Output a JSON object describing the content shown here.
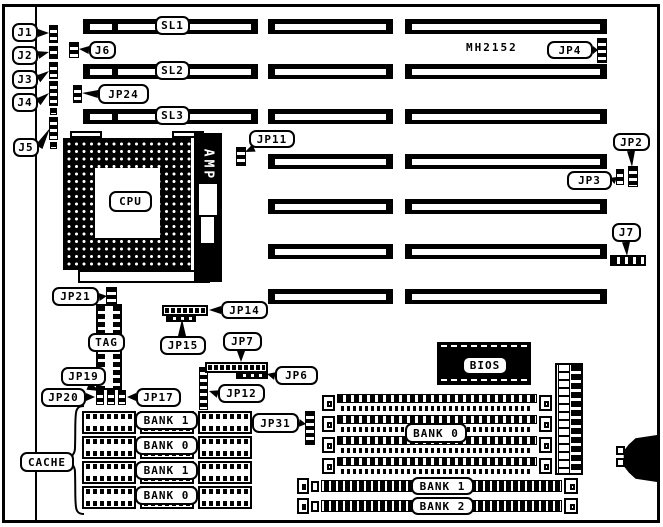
{
  "board": {
    "model": "MH2152"
  },
  "chips": {
    "cpu": "CPU",
    "amp": "AMP",
    "tag": "TAG",
    "bios": "BIOS"
  },
  "memory": {
    "cache_label": "CACHE",
    "cache_banks": [
      "BANK 1",
      "BANK 0",
      "BANK 1",
      "BANK 0"
    ],
    "simm30_label": "BANK 0",
    "simm72_labels": [
      "BANK 1",
      "BANK 2"
    ]
  },
  "slots": {
    "labels": [
      "SL1",
      "SL2",
      "SL3"
    ]
  },
  "plates": [
    {
      "label": "SL1",
      "name": "slot-label-sl1",
      "box": [
        155,
        16,
        35,
        19
      ]
    },
    {
      "label": "SL2",
      "name": "slot-label-sl2",
      "box": [
        155,
        61,
        35,
        19
      ]
    },
    {
      "label": "SL3",
      "name": "slot-label-sl3",
      "box": [
        155,
        106,
        35,
        19
      ]
    },
    {
      "label": "CPU",
      "name": "cpu-label",
      "box": [
        109,
        191,
        43,
        21
      ]
    },
    {
      "label": "TAG",
      "name": "tag-label",
      "box": [
        88,
        333,
        37,
        19
      ]
    },
    {
      "label": "BIOS",
      "name": "bios-label",
      "box": [
        462,
        356,
        46,
        19
      ]
    },
    {
      "label": "CACHE",
      "name": "cache-label",
      "box": [
        20,
        452,
        54,
        20
      ]
    },
    {
      "label": "BANK 1",
      "name": "cache-bank1-row1-label",
      "box": [
        135,
        411,
        63,
        19
      ]
    },
    {
      "label": "BANK 0",
      "name": "cache-bank0-row2-label",
      "box": [
        135,
        436,
        63,
        19
      ]
    },
    {
      "label": "BANK 1",
      "name": "cache-bank1-row3-label",
      "box": [
        135,
        461,
        63,
        19
      ]
    },
    {
      "label": "BANK 0",
      "name": "cache-bank0-row4-label",
      "box": [
        135,
        486,
        63,
        19
      ]
    },
    {
      "label": "BANK 0",
      "name": "simm-bank0-label",
      "box": [
        405,
        423,
        62,
        20
      ]
    },
    {
      "label": "BANK 1",
      "name": "simm-bank1-label",
      "box": [
        411,
        477,
        63,
        18
      ]
    },
    {
      "label": "BANK 2",
      "name": "simm-bank2-label",
      "box": [
        411,
        497,
        63,
        18
      ]
    }
  ],
  "callouts": [
    {
      "label": "J1",
      "name": "callout-j1",
      "box": [
        12,
        23,
        26,
        19
      ],
      "from": [
        38,
        33
      ],
      "to": [
        49,
        33
      ]
    },
    {
      "label": "J2",
      "name": "callout-j2",
      "box": [
        12,
        46,
        26,
        19
      ],
      "from": [
        38,
        55
      ],
      "to": [
        49,
        52
      ]
    },
    {
      "label": "J3",
      "name": "callout-j3",
      "box": [
        12,
        70,
        26,
        19
      ],
      "from": [
        38,
        79
      ],
      "to": [
        49,
        71
      ]
    },
    {
      "label": "J4",
      "name": "callout-j4",
      "box": [
        12,
        93,
        26,
        19
      ],
      "from": [
        38,
        102
      ],
      "to": [
        49,
        93
      ]
    },
    {
      "label": "J5",
      "name": "callout-j5",
      "box": [
        13,
        138,
        26,
        19
      ],
      "from": [
        39,
        147
      ],
      "to": [
        50,
        128
      ]
    },
    {
      "label": "J6",
      "name": "callout-j6",
      "box": [
        89,
        41,
        27,
        18
      ],
      "from": [
        89,
        50
      ],
      "to": [
        79,
        49
      ]
    },
    {
      "label": "JP24",
      "name": "callout-jp24",
      "box": [
        98,
        84,
        51,
        20
      ],
      "from": [
        98,
        94
      ],
      "to": [
        82,
        93
      ]
    },
    {
      "label": "JP4",
      "name": "callout-jp4",
      "box": [
        547,
        41,
        46,
        18
      ],
      "from": [
        593,
        50
      ],
      "to": [
        598,
        50
      ]
    },
    {
      "label": "JP11",
      "name": "callout-jp11",
      "box": [
        249,
        130,
        46,
        18
      ],
      "from": [
        254,
        148
      ],
      "to": [
        245,
        152
      ]
    },
    {
      "label": "JP2",
      "name": "callout-jp2",
      "box": [
        613,
        133,
        37,
        18
      ],
      "from": [
        631,
        151
      ],
      "to": [
        632,
        167
      ]
    },
    {
      "label": "JP3",
      "name": "callout-jp3",
      "box": [
        567,
        171,
        45,
        19
      ],
      "from": [
        612,
        181
      ],
      "to": [
        617,
        177
      ]
    },
    {
      "label": "J7",
      "name": "callout-j7",
      "box": [
        612,
        223,
        29,
        19
      ],
      "from": [
        626,
        242
      ],
      "to": [
        627,
        256
      ]
    },
    {
      "label": "JP21",
      "name": "callout-jp21",
      "box": [
        52,
        287,
        47,
        19
      ],
      "from": [
        99,
        297
      ],
      "to": [
        107,
        296
      ]
    },
    {
      "label": "JP14",
      "name": "callout-jp14",
      "box": [
        221,
        301,
        47,
        18
      ],
      "from": [
        221,
        310
      ],
      "to": [
        209,
        310
      ]
    },
    {
      "label": "JP15",
      "name": "callout-jp15",
      "box": [
        160,
        336,
        46,
        19
      ],
      "from": [
        182,
        336
      ],
      "to": [
        182,
        319
      ]
    },
    {
      "label": "JP7",
      "name": "callout-jp7",
      "box": [
        223,
        332,
        39,
        19
      ],
      "from": [
        241,
        351
      ],
      "to": [
        241,
        362
      ]
    },
    {
      "label": "JP6",
      "name": "callout-jp6",
      "box": [
        275,
        366,
        43,
        19
      ],
      "from": [
        275,
        376
      ],
      "to": [
        267,
        374
      ]
    },
    {
      "label": "JP12",
      "name": "callout-jp12",
      "box": [
        218,
        384,
        47,
        19
      ],
      "from": [
        218,
        394
      ],
      "to": [
        209,
        391
      ]
    },
    {
      "label": "JP19",
      "name": "callout-jp19",
      "box": [
        61,
        367,
        45,
        19
      ],
      "from": [
        88,
        386
      ],
      "to": [
        100,
        391
      ]
    },
    {
      "label": "JP20",
      "name": "callout-jp20",
      "box": [
        41,
        388,
        45,
        19
      ],
      "from": [
        86,
        397
      ],
      "to": [
        95,
        397
      ]
    },
    {
      "label": "JP17",
      "name": "callout-jp17",
      "box": [
        136,
        388,
        45,
        19
      ],
      "from": [
        136,
        397
      ],
      "to": [
        127,
        397
      ]
    },
    {
      "label": "JP31",
      "name": "callout-jp31",
      "box": [
        252,
        413,
        47,
        20
      ],
      "from": [
        299,
        423
      ],
      "to": [
        306,
        424
      ]
    }
  ],
  "geometry": {
    "slot_rows": {
      "y0": 19,
      "dy": 45,
      "h": 15,
      "count": 7,
      "col1": {
        "x": 83,
        "w": 175,
        "rows": 3
      },
      "col2": {
        "x": 268,
        "w": 125
      },
      "col3": {
        "x": 405,
        "w": 202
      }
    },
    "pin_strips": [
      [
        49,
        25,
        9,
        18,
        "v",
        "j1-header"
      ],
      [
        49,
        46,
        9,
        13,
        "v",
        "j2-header"
      ],
      [
        49,
        62,
        9,
        17,
        "v",
        "j3-header"
      ],
      [
        49,
        81,
        9,
        25,
        "v",
        "j4-header"
      ],
      [
        50,
        108,
        7,
        7,
        "v",
        "edge-pin-a"
      ],
      [
        49,
        117,
        9,
        23,
        "v",
        "j5-header"
      ],
      [
        50,
        142,
        7,
        7,
        "v",
        "edge-pin-b"
      ],
      [
        69,
        42,
        10,
        16,
        "v",
        "j6-jumper"
      ],
      [
        73,
        85,
        9,
        18,
        "v",
        "jp24-jumper"
      ],
      [
        597,
        38,
        10,
        25,
        "v",
        "jp4-jumper"
      ],
      [
        236,
        147,
        10,
        19,
        "v",
        "jp11-jumper"
      ],
      [
        628,
        166,
        10,
        21,
        "v",
        "jp2-jumper"
      ],
      [
        616,
        169,
        8,
        16,
        "v",
        "jp3-jumper"
      ],
      [
        106,
        287,
        11,
        17,
        "v",
        "jp21-jumper"
      ],
      [
        199,
        367,
        9,
        43,
        "v",
        "jp12-header"
      ],
      [
        96,
        390,
        8,
        15,
        "v",
        "jp19-jumper"
      ],
      [
        107,
        390,
        8,
        15,
        "v",
        "jp20-jumper"
      ],
      [
        118,
        390,
        8,
        15,
        "v",
        "jp17-jumper"
      ],
      [
        305,
        411,
        10,
        34,
        "v",
        "jp31-header"
      ],
      [
        610,
        255,
        36,
        11,
        "h",
        "j7-header"
      ]
    ],
    "pin_headers": [
      {
        "name": "jp14-header",
        "outer": [
          162,
          305,
          46,
          11
        ],
        "row2": [
          166,
          315,
          30,
          7
        ]
      },
      {
        "name": "jp7-header",
        "outer": [
          205,
          362,
          63,
          11
        ],
        "row2": [
          236,
          372,
          32,
          7
        ]
      }
    ],
    "cache_rows": {
      "ys": [
        411,
        436,
        461,
        486
      ],
      "chip_xs": [
        82,
        140,
        198
      ],
      "chip_w": 54,
      "chip_h": 23
    },
    "simm30_rows": {
      "ys": [
        394,
        415,
        436,
        457
      ],
      "x": 322,
      "w": 230,
      "h": 18
    },
    "simm72_rows": {
      "ys": [
        478,
        498
      ],
      "x": 297,
      "w": 281,
      "h": 17
    }
  }
}
